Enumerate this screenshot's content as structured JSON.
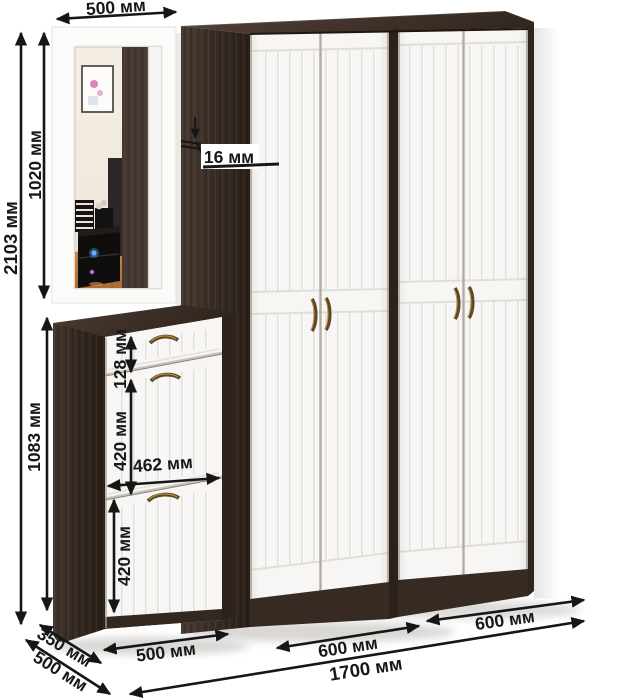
{
  "image": {
    "kind": "furniture-dimension-diagram",
    "units": "мм"
  },
  "dimensions": {
    "mirror_width": "500 мм",
    "total_height": "2103 мм",
    "mirror_height": "1020 мм",
    "cabinet_height": "1083 мм",
    "panel_thickness": "16 мм",
    "drawer_height": "128 мм",
    "upper_flap_height": "420 мм",
    "inner_width": "462 мм",
    "lower_flap_height": "420 мм",
    "cabinet_top_depth": "350 мм",
    "cabinet_base_depth": "500 мм",
    "cabinet_width": "500 мм",
    "left_wardrobe_width": "600 мм",
    "right_wardrobe_width": "600 мм",
    "total_width": "1700 мм"
  },
  "colors": {
    "wenge": "#3a2d25",
    "door_white": "#f7f6f4",
    "dimension_ink": "#181818",
    "handle_bronze": "#5d4823"
  }
}
